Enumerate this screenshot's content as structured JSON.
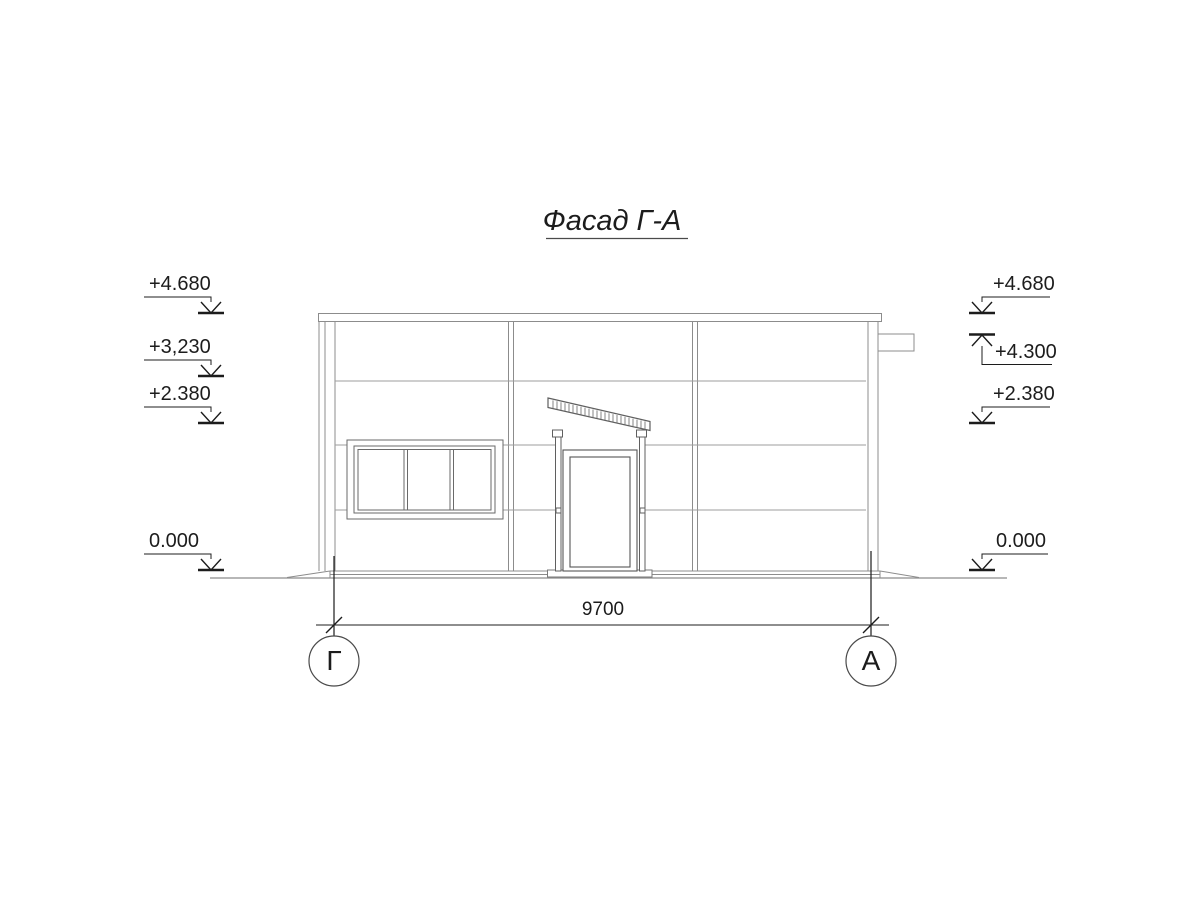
{
  "title": "Фасад Г-А",
  "dimension": {
    "value": "9700"
  },
  "axes": {
    "left": "Г",
    "right": "А"
  },
  "elevations": {
    "left": [
      {
        "value": "+4.680"
      },
      {
        "value": "+3,230"
      },
      {
        "value": "+2.380"
      },
      {
        "value": "0.000"
      }
    ],
    "right": [
      {
        "value": "+4.680"
      },
      {
        "value": "+4.300"
      },
      {
        "value": "+2.380"
      },
      {
        "value": "0.000"
      }
    ]
  },
  "colors": {
    "background": "#ffffff",
    "panel_line": "#9e9e9e",
    "building_line": "#8c8c8c",
    "detail_line": "#606060",
    "annotation": "#1c1c1c"
  }
}
